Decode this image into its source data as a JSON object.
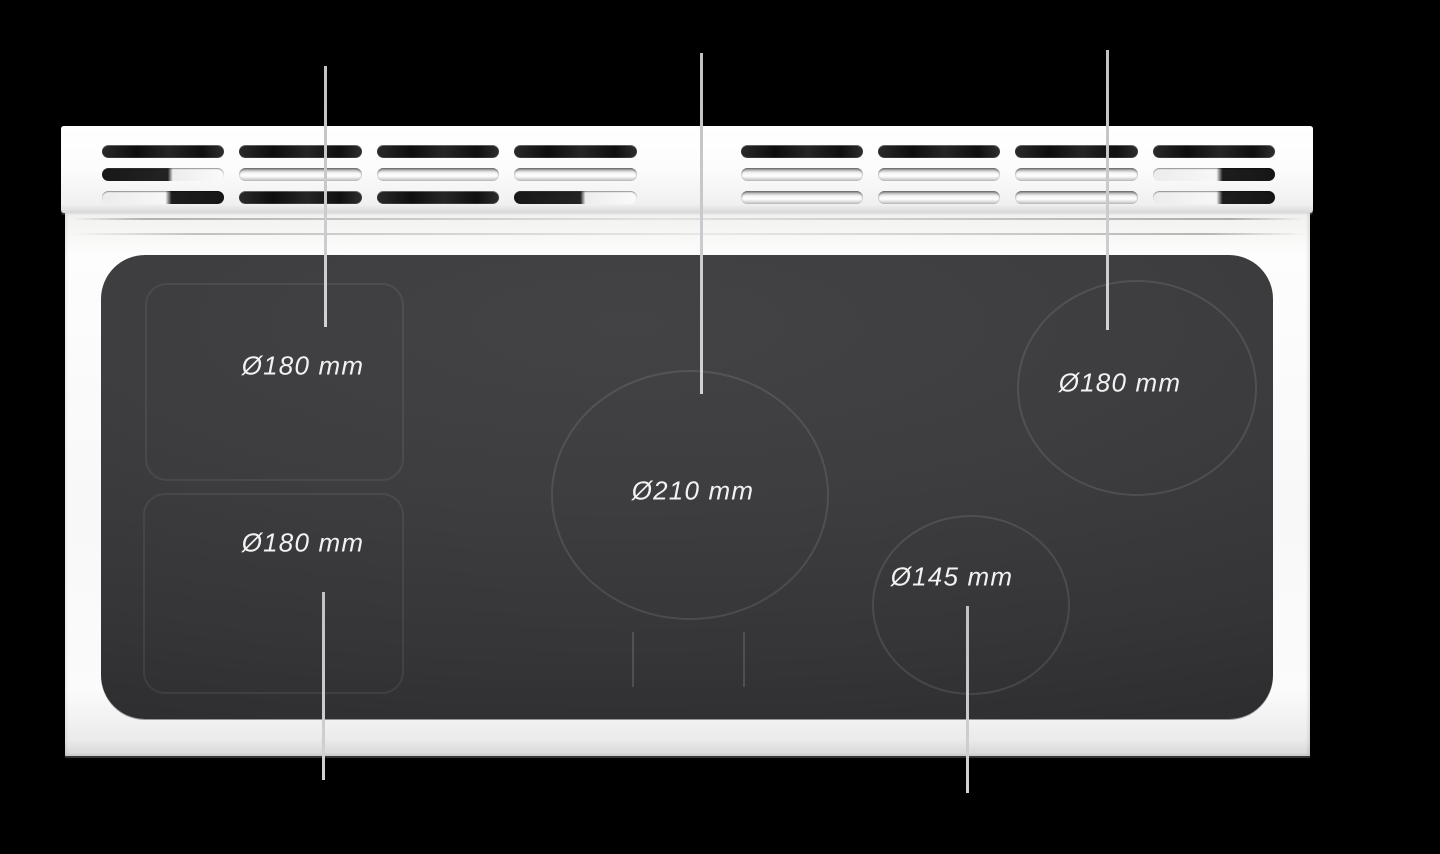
{
  "cooktop": {
    "view": "top",
    "vent_grille": {
      "groups": 8,
      "slots_per_group": 3
    },
    "burners": [
      {
        "id": "left-flex-top",
        "label": "Ø180 mm",
        "diameter_mm": 180,
        "outline": "rounded-rectangle"
      },
      {
        "id": "left-flex-bottom",
        "label": "Ø180 mm",
        "diameter_mm": 180,
        "outline": "rounded-rectangle"
      },
      {
        "id": "center",
        "label": "Ø210 mm",
        "diameter_mm": 210,
        "outline": "circle"
      },
      {
        "id": "right-top",
        "label": "Ø180 mm",
        "diameter_mm": 180,
        "outline": "circle"
      },
      {
        "id": "right-bottom",
        "label": "Ø145 mm",
        "diameter_mm": 145,
        "outline": "circle"
      }
    ],
    "colors": {
      "background": "#000000",
      "frame": "#f7f7f7",
      "glass": "#3b3b3d",
      "burner_outline": "#4c4c4e",
      "leader_line": "#c7c7c9",
      "label_text": "#f2f2f2"
    }
  }
}
